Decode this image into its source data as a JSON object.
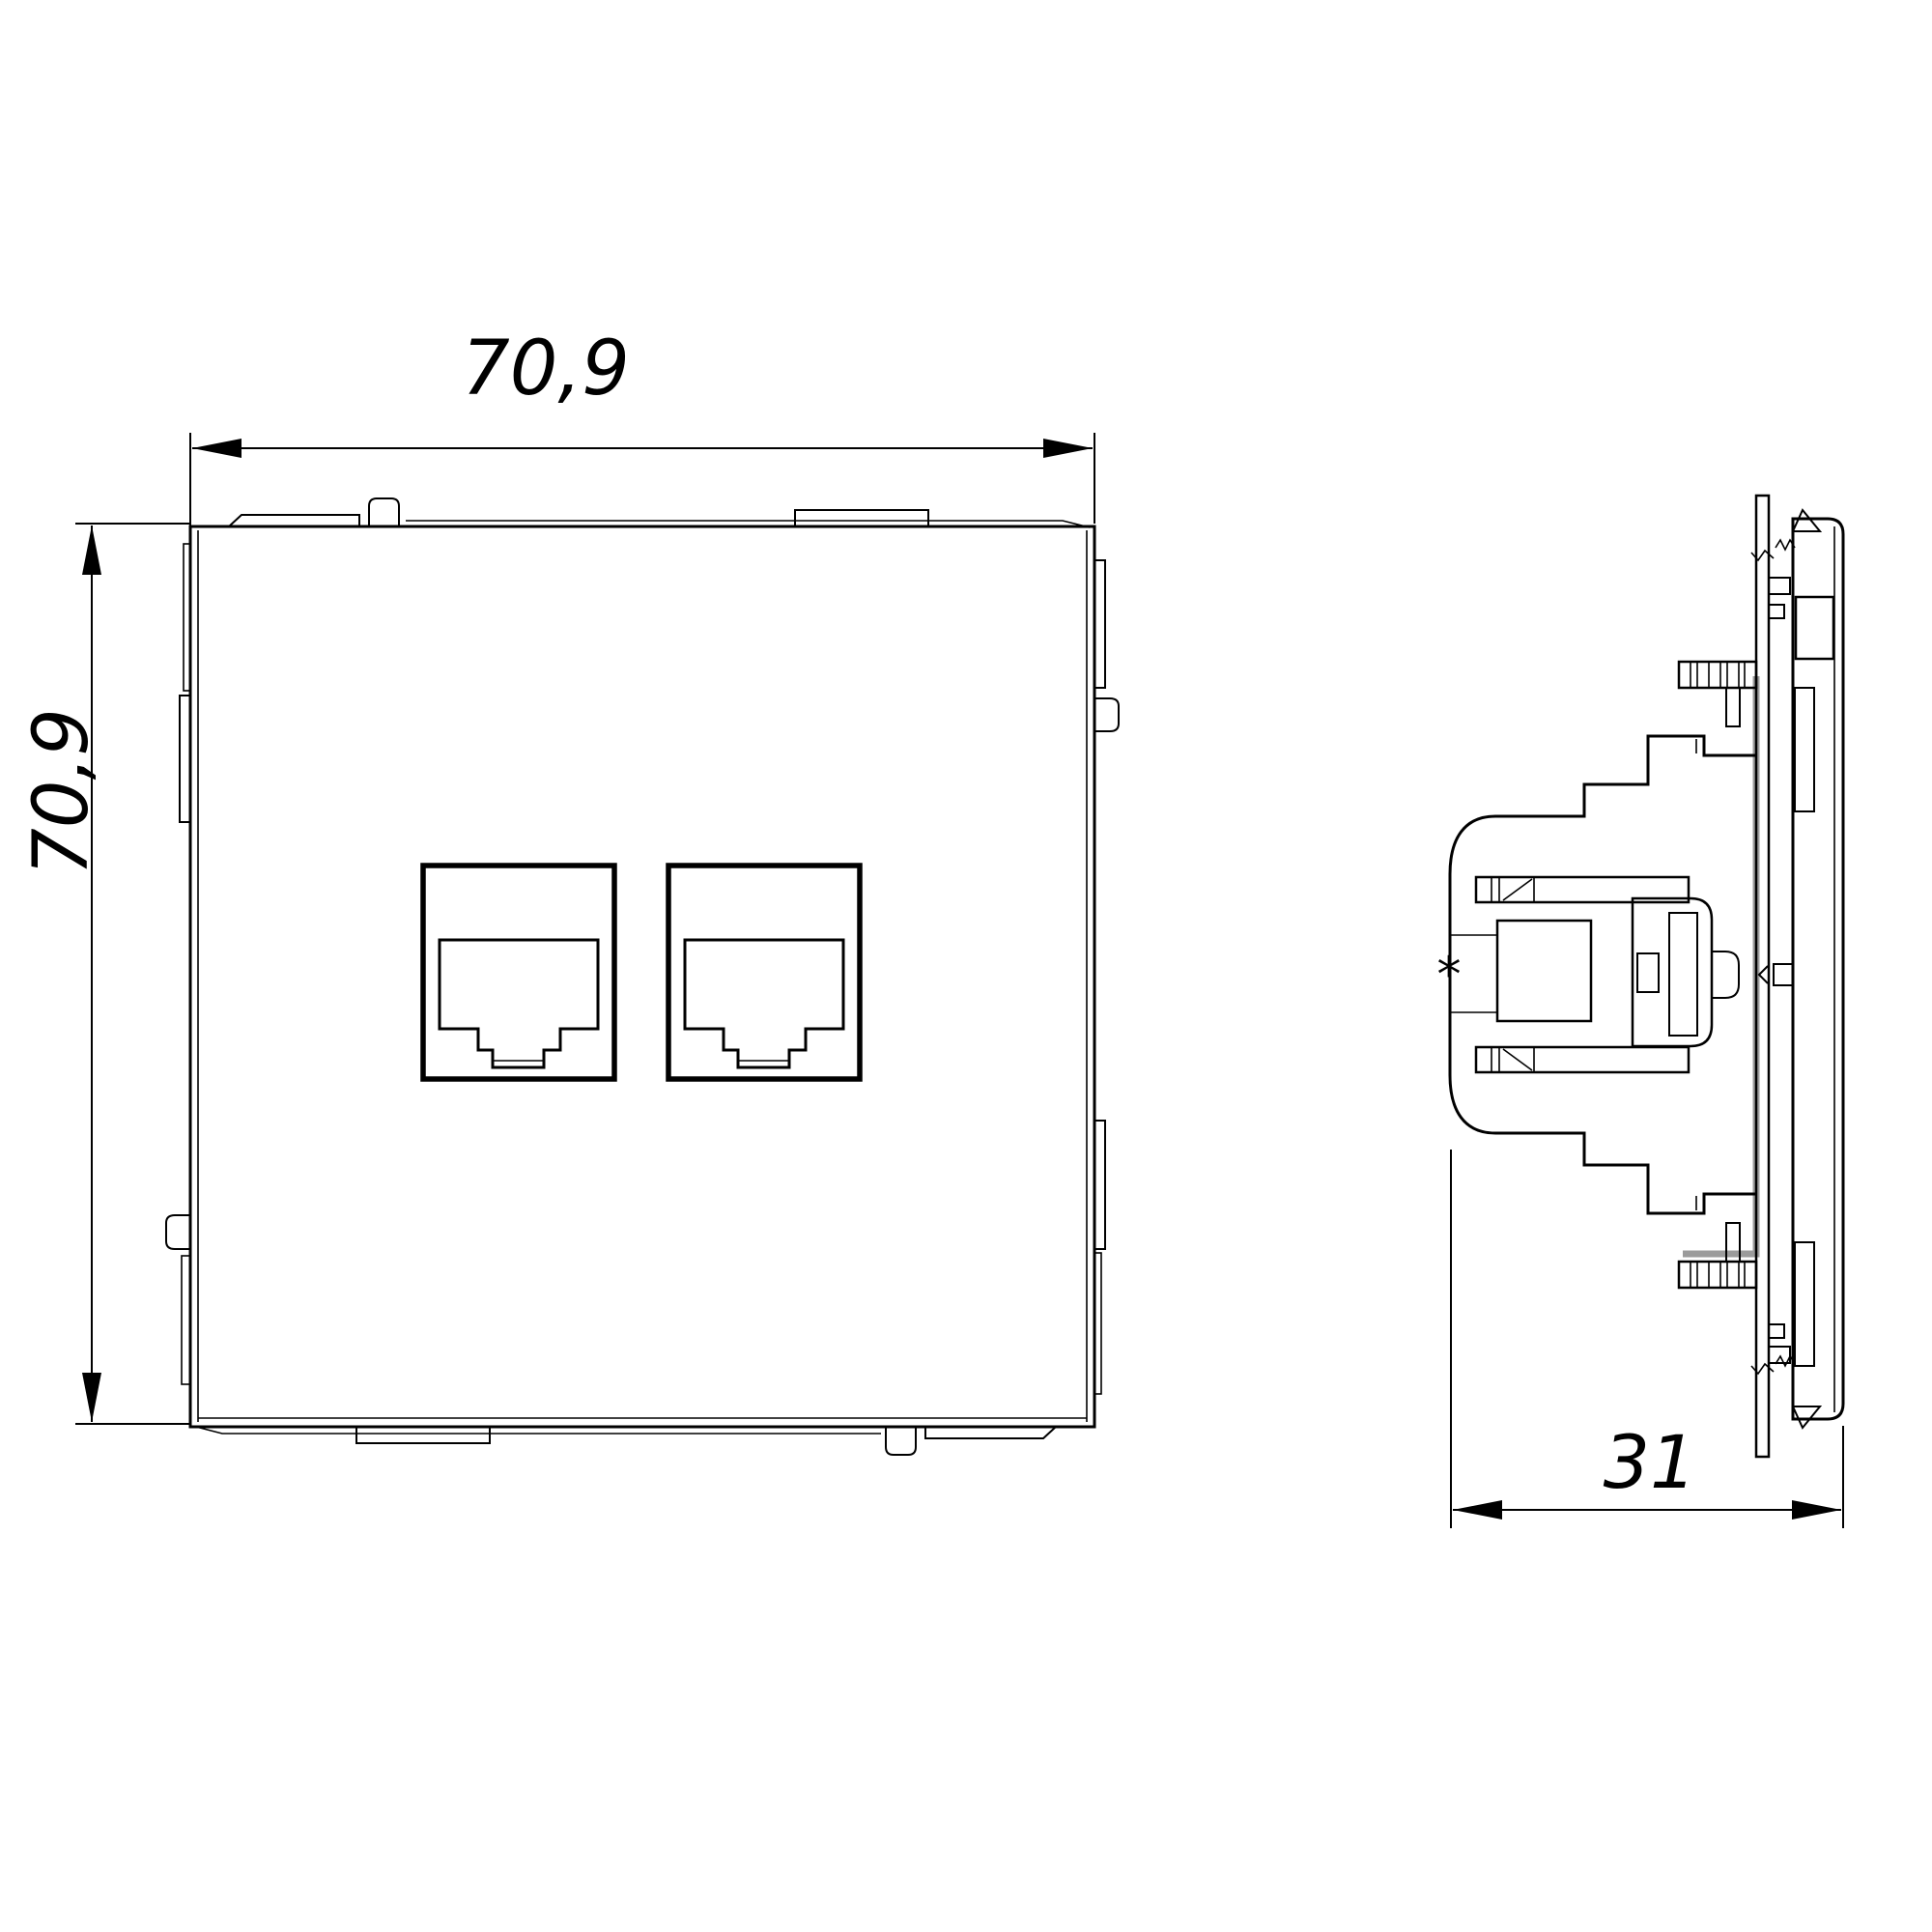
{
  "drawing": {
    "views": {
      "front": {
        "name": "front-view"
      },
      "side": {
        "name": "side-view"
      }
    },
    "dimensions": {
      "front_width": {
        "value": "70,9"
      },
      "front_height": {
        "value": "70,9"
      },
      "side_depth": {
        "value": "31"
      }
    },
    "markers": {
      "reference_asterisk": "*"
    }
  },
  "colors": {
    "background": "#ffffff",
    "line": "#000000",
    "highlight": "#9b9b9b"
  }
}
